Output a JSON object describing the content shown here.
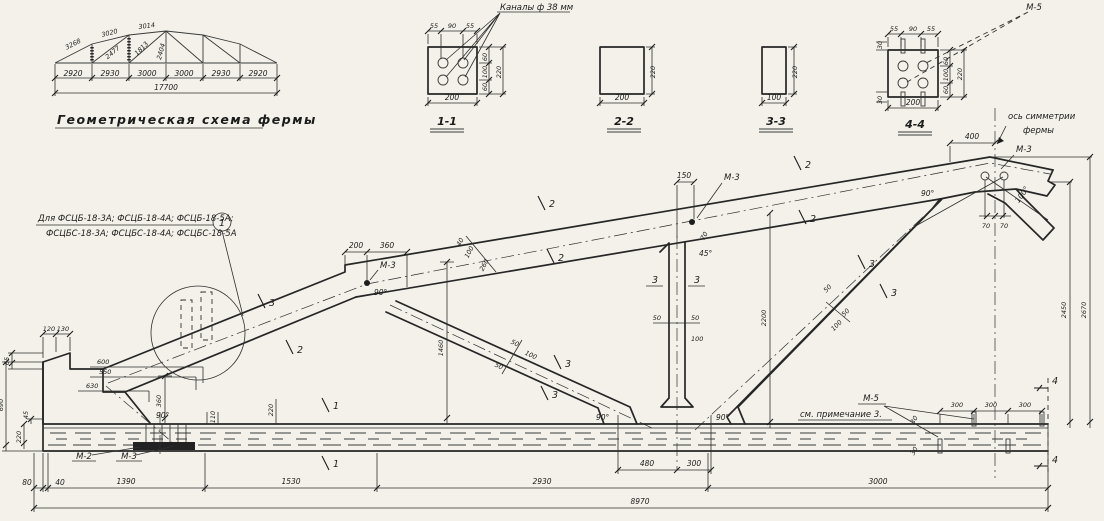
{
  "scheme": {
    "caption": "Геометрическая схема фермы",
    "top_dims": [
      "3268",
      "3020",
      "3014"
    ],
    "web_dims": [
      "2477",
      "1813",
      "2404"
    ],
    "panel_dims": [
      "2920",
      "2930",
      "3000",
      "3000",
      "2930",
      "2920"
    ],
    "total": "17700"
  },
  "sections": {
    "channels_note": "Каналы ф 38 мм",
    "titles": [
      "1-1",
      "2-2",
      "3-3",
      "4-4"
    ]
  },
  "notes": {
    "note1": "Для ФСЦБ-18-3А; ФСЦБ-18-4А; ФСЦБ-18-5А;",
    "note2": "ФСЦБС-18-3А; ФСЦБС-18-4А; ФСЦБС-18-5А",
    "callout1": "1",
    "axis1": "ось симметрии",
    "axis2": "фермы",
    "m2": "М-2",
    "m3": "М-3",
    "m5": "М-5",
    "m5_note": "см. примечание 3."
  },
  "angles": {
    "a90": "90°",
    "a45": "45°",
    "a100": "100°"
  },
  "flags": {
    "f1": "1",
    "f2": "2",
    "f3": "3",
    "f4": "4"
  },
  "dims": {
    "30": "30",
    "40": "40",
    "45": "45",
    "50": "50",
    "55": "55",
    "60": "60",
    "65": "65",
    "70": "70",
    "80": "80",
    "90": "90",
    "100": "100",
    "110": "110",
    "120": "120",
    "130": "130",
    "150": "150",
    "200": "200",
    "220": "220",
    "260": "260",
    "300": "300",
    "360": "360",
    "400": "400",
    "480": "480",
    "550": "550",
    "600": "600",
    "630": "630",
    "690": "690",
    "1390": "1390",
    "1460": "1460",
    "1530": "1530",
    "2200": "2200",
    "2450": "2450",
    "2670": "2670",
    "2930": "2930",
    "3000": "3000",
    "8970": "8970"
  }
}
